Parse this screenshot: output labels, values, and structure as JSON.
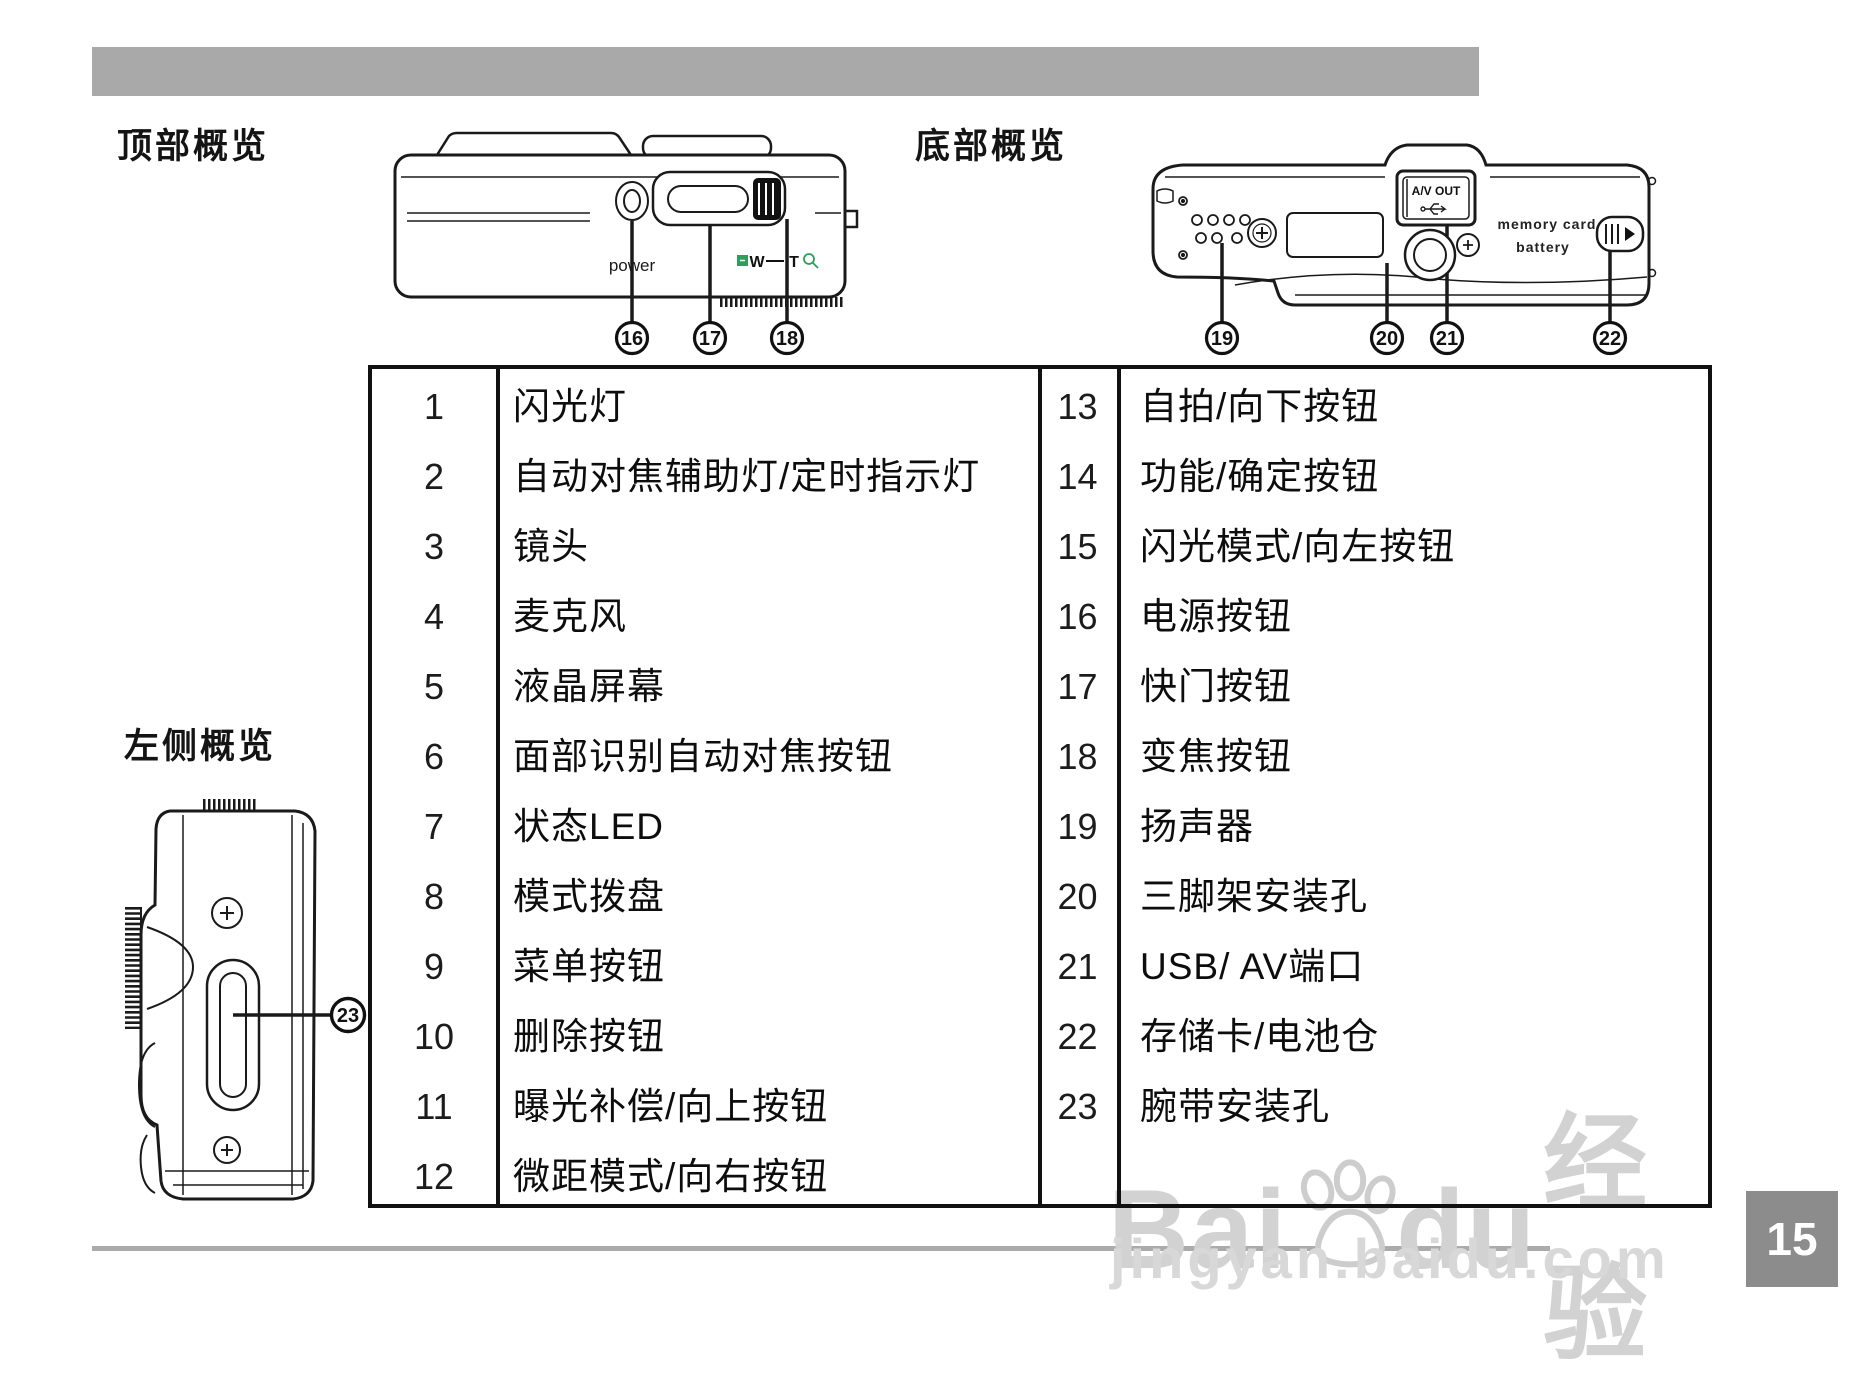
{
  "sections": {
    "top_overview": "顶部概览",
    "bottom_overview": "底部概览",
    "left_overview": "左侧概览"
  },
  "top_diagram": {
    "power_label": "power",
    "zoom_wide": "W",
    "zoom_tele": "T",
    "callouts": [
      "16",
      "17",
      "18"
    ]
  },
  "bottom_diagram": {
    "av_out_label": "A/V OUT",
    "memory_card_label": "memory card",
    "battery_label": "battery",
    "callouts": [
      "19",
      "20",
      "21",
      "22"
    ]
  },
  "left_diagram": {
    "callout": "23"
  },
  "table": {
    "left_rows": [
      {
        "num": "1",
        "label": "闪光灯"
      },
      {
        "num": "2",
        "label": "自动对焦辅助灯/定时指示灯"
      },
      {
        "num": "3",
        "label": "镜头"
      },
      {
        "num": "4",
        "label": "麦克风"
      },
      {
        "num": "5",
        "label": "液晶屏幕"
      },
      {
        "num": "6",
        "label": "面部识别自动对焦按钮"
      },
      {
        "num": "7",
        "label": "状态LED"
      },
      {
        "num": "8",
        "label": "模式拨盘"
      },
      {
        "num": "9",
        "label": "菜单按钮"
      },
      {
        "num": "10",
        "label": "删除按钮"
      },
      {
        "num": "11",
        "label": "曝光补偿/向上按钮"
      },
      {
        "num": "12",
        "label": "微距模式/向右按钮"
      }
    ],
    "right_rows": [
      {
        "num": "13",
        "label": "自拍/向下按钮"
      },
      {
        "num": "14",
        "label": "功能/确定按钮"
      },
      {
        "num": "15",
        "label": "闪光模式/向左按钮"
      },
      {
        "num": "16",
        "label": "电源按钮"
      },
      {
        "num": "17",
        "label": "快门按钮"
      },
      {
        "num": "18",
        "label": "变焦按钮"
      },
      {
        "num": "19",
        "label": "扬声器"
      },
      {
        "num": "20",
        "label": "三脚架安装孔"
      },
      {
        "num": "21",
        "label": "USB/ AV端口"
      },
      {
        "num": "22",
        "label": "存储卡/电池仓"
      },
      {
        "num": "23",
        "label": "腕带安装孔"
      }
    ]
  },
  "watermark": {
    "brand_a": "Bai",
    "brand_b": "du",
    "brand_suffix": "经验",
    "url": "jingyan.baidu.com"
  },
  "page": {
    "number": "15"
  },
  "colors": {
    "accent_green": "#2e9e5b",
    "header_bar": "#a9a9a9",
    "page_box": "#8c8c8c"
  }
}
